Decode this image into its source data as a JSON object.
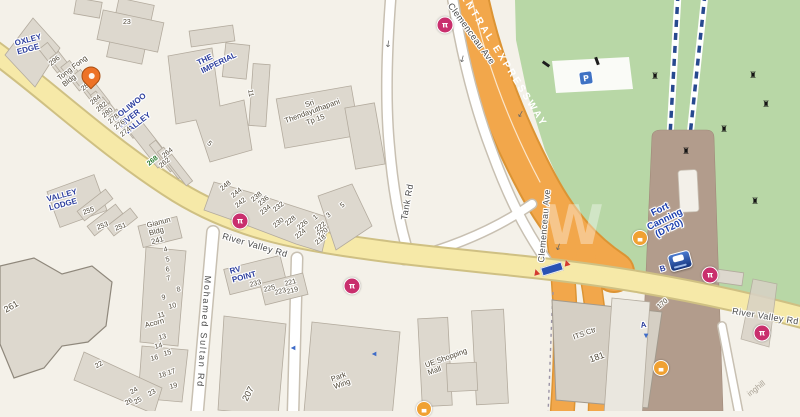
{
  "map": {
    "area_name": "River Valley / Fort Canning",
    "palette": {
      "background": "#f4f1e9",
      "park_green": "#b8d7a6",
      "expressway_orange": "#f2a74b",
      "expressway_casing": "#dc9434",
      "road_yellow": "#f6e9a8",
      "road_yellow_casing": "#cfc083",
      "road_white": "#ffffff",
      "road_white_casing": "#c8c0b2",
      "station_strip_brown": "#b29c8c",
      "building_fill": "#ddd8ce",
      "building_stroke": "#b3ab9e",
      "condo_blue": "#2c3e9e",
      "station_blue": "#1c3fae",
      "erp_magenta": "#c92f6d",
      "taxi_orange": "#f0a132",
      "parking_blue": "#3f72c4",
      "mrt_line_blue": "#27498f",
      "number_green": "#2e7d32"
    },
    "road_names": [
      "River Valley Rd",
      "Mohamed Sultan Rd",
      "Tank Rd",
      "Clemenceau Ave",
      "CENTRAL EXPRESSWAY"
    ],
    "labels": [
      {
        "t": "OXLEY\nEDGE",
        "x": 14,
        "y": 40,
        "r": -15,
        "c": "place",
        "n": "label-oxley-edge"
      },
      {
        "t": "THE\nIMPERIAL",
        "x": 196,
        "y": 60,
        "r": -26,
        "c": "place",
        "n": "label-the-imperial"
      },
      {
        "t": "COLIWOO\nRIVER\nVALLEY",
        "x": 112,
        "y": 116,
        "r": -38,
        "c": "place",
        "n": "label-coliwoo-river-valley"
      },
      {
        "t": "268",
        "x": 146,
        "y": 162,
        "r": -38,
        "c": "num g",
        "n": "label-268"
      },
      {
        "t": "VALLEY\nLODGE",
        "x": 46,
        "y": 196,
        "r": -15,
        "c": "place",
        "n": "label-valley-lodge"
      },
      {
        "t": "RV\nPOINT",
        "x": 229,
        "y": 268,
        "r": -15,
        "c": "place",
        "n": "label-rv-point"
      },
      {
        "t": "Fort\nCanning\n(DT20)",
        "x": 641,
        "y": 214,
        "r": -26,
        "c": "station ctr",
        "n": "label-fort-canning-dt20"
      },
      {
        "t": "Tong Fong\nBldg",
        "x": 56,
        "y": 76,
        "r": -38,
        "c": "bldg",
        "n": "label-tong-fong-bldg"
      },
      {
        "t": "Sri\nThendayuthapani\nTp 15",
        "x": 281,
        "y": 110,
        "r": -20,
        "c": "bldg ctr",
        "n": "label-sri-thendayuthapani"
      },
      {
        "t": "Gianun\nBldg\n241",
        "x": 146,
        "y": 222,
        "r": -15,
        "c": "bldg",
        "n": "label-gianun-bldg-241"
      },
      {
        "t": "Acorn",
        "x": 144,
        "y": 322,
        "r": -15,
        "c": "bldg",
        "n": "label-acorn"
      },
      {
        "t": "Park\nWing",
        "x": 330,
        "y": 376,
        "r": -20,
        "c": "bldg",
        "n": "label-park-wing"
      },
      {
        "t": "UE Shopping\nMall",
        "x": 424,
        "y": 362,
        "r": -20,
        "c": "bldg",
        "n": "label-ue-shopping-mall"
      },
      {
        "t": "ITS Ctr",
        "x": 572,
        "y": 334,
        "r": -20,
        "c": "bldg",
        "n": "label-its-ctr"
      },
      {
        "t": "inghill",
        "x": 746,
        "y": 392,
        "r": -38,
        "c": "faint",
        "n": "label-inghill"
      },
      {
        "t": "River Valley Rd",
        "x": 224,
        "y": 231,
        "r": 16,
        "c": "road",
        "n": "label-river-valley-rd-west"
      },
      {
        "t": "River Valley Rd",
        "x": 733,
        "y": 306,
        "r": 9,
        "c": "road",
        "n": "label-river-valley-rd-east"
      },
      {
        "t": "Mohamed Sultan Rd",
        "x": 213,
        "y": 276,
        "r": 94,
        "ls": 1.8,
        "c": "road",
        "n": "label-mohamed-sultan-rd"
      },
      {
        "t": "Tank Rd",
        "x": 399,
        "y": 219,
        "r": -80,
        "ls": 0.5,
        "c": "road",
        "n": "label-tank-rd"
      },
      {
        "t": "Clemenceau Ave",
        "x": 454,
        "y": 1,
        "r": 54,
        "c": "road",
        "n": "label-clemenceau-ave-north"
      },
      {
        "t": "Clemenceau Ave",
        "x": 536,
        "y": 262,
        "r": -85,
        "c": "road",
        "n": "label-clemenceau-ave-mid"
      },
      {
        "t": "CENTRAL EXPRESSWAY",
        "x": 462,
        "y": -16,
        "r": 58,
        "c": "xway",
        "n": "label-central-expressway"
      },
      {
        "t": "23",
        "x": 123,
        "y": 19,
        "r": 0,
        "c": "num"
      },
      {
        "t": "296",
        "x": 48,
        "y": 62,
        "r": -38,
        "c": "num"
      },
      {
        "t": "288",
        "x": 80,
        "y": 87,
        "r": -38,
        "c": "num"
      },
      {
        "t": "284",
        "x": 89,
        "y": 101,
        "r": -38,
        "c": "num"
      },
      {
        "t": "282",
        "x": 95,
        "y": 108,
        "r": -38,
        "c": "num"
      },
      {
        "t": "280",
        "x": 101,
        "y": 114,
        "r": -38,
        "c": "num"
      },
      {
        "t": "278",
        "x": 107,
        "y": 120,
        "r": -38,
        "c": "num"
      },
      {
        "t": "276",
        "x": 113,
        "y": 126,
        "r": -38,
        "c": "num"
      },
      {
        "t": "274",
        "x": 119,
        "y": 133,
        "r": -38,
        "c": "num"
      },
      {
        "t": "264",
        "x": 161,
        "y": 154,
        "r": -38,
        "c": "num"
      },
      {
        "t": "262",
        "x": 158,
        "y": 164,
        "r": -38,
        "c": "num"
      },
      {
        "t": "11",
        "x": 253,
        "y": 89,
        "r": 80,
        "c": "num"
      },
      {
        "t": "5",
        "x": 210,
        "y": 140,
        "r": 40,
        "c": "num"
      },
      {
        "t": "255",
        "x": 82,
        "y": 210,
        "r": -20,
        "c": "num"
      },
      {
        "t": "253",
        "x": 96,
        "y": 225,
        "r": -20,
        "c": "num"
      },
      {
        "t": "251",
        "x": 114,
        "y": 226,
        "r": -20,
        "c": "num"
      },
      {
        "t": "248",
        "x": 219,
        "y": 187,
        "r": -38,
        "c": "num"
      },
      {
        "t": "244",
        "x": 230,
        "y": 194,
        "r": -38,
        "c": "num"
      },
      {
        "t": "242",
        "x": 234,
        "y": 204,
        "r": -38,
        "c": "num"
      },
      {
        "t": "238",
        "x": 250,
        "y": 198,
        "r": -38,
        "c": "num"
      },
      {
        "t": "236",
        "x": 257,
        "y": 202,
        "r": -38,
        "c": "num"
      },
      {
        "t": "234",
        "x": 259,
        "y": 211,
        "r": -38,
        "c": "num"
      },
      {
        "t": "232",
        "x": 272,
        "y": 208,
        "r": -38,
        "c": "num"
      },
      {
        "t": "230",
        "x": 272,
        "y": 224,
        "r": -38,
        "c": "num"
      },
      {
        "t": "228",
        "x": 284,
        "y": 222,
        "r": -38,
        "c": "num"
      },
      {
        "t": "226",
        "x": 296,
        "y": 226,
        "r": -38,
        "c": "num"
      },
      {
        "t": "224",
        "x": 294,
        "y": 235,
        "r": -38,
        "c": "num"
      },
      {
        "t": "222",
        "x": 314,
        "y": 228,
        "r": -38,
        "c": "num"
      },
      {
        "t": "220",
        "x": 316,
        "y": 234,
        "r": -38,
        "c": "num"
      },
      {
        "t": "218",
        "x": 314,
        "y": 241,
        "r": -38,
        "c": "num"
      },
      {
        "t": "1",
        "x": 312,
        "y": 216,
        "r": -38,
        "c": "num"
      },
      {
        "t": "3",
        "x": 325,
        "y": 214,
        "r": -38,
        "c": "num"
      },
      {
        "t": "5",
        "x": 339,
        "y": 204,
        "r": -38,
        "c": "num"
      },
      {
        "t": "233",
        "x": 249,
        "y": 282,
        "r": -15,
        "c": "num"
      },
      {
        "t": "225",
        "x": 263,
        "y": 287,
        "r": -15,
        "c": "num"
      },
      {
        "t": "223",
        "x": 274,
        "y": 290,
        "r": -15,
        "c": "num"
      },
      {
        "t": "221",
        "x": 284,
        "y": 281,
        "r": -15,
        "c": "num"
      },
      {
        "t": "219",
        "x": 286,
        "y": 289,
        "r": -15,
        "c": "num"
      },
      {
        "t": "4",
        "x": 163,
        "y": 247,
        "r": -15,
        "c": "num"
      },
      {
        "t": "5",
        "x": 165,
        "y": 257,
        "r": -15,
        "c": "num"
      },
      {
        "t": "6",
        "x": 165,
        "y": 267,
        "r": -15,
        "c": "num"
      },
      {
        "t": "7",
        "x": 166,
        "y": 276,
        "r": -15,
        "c": "num"
      },
      {
        "t": "8",
        "x": 176,
        "y": 287,
        "r": -15,
        "c": "num"
      },
      {
        "t": "9",
        "x": 161,
        "y": 295,
        "r": -15,
        "c": "num"
      },
      {
        "t": "10",
        "x": 168,
        "y": 304,
        "r": -15,
        "c": "num"
      },
      {
        "t": "11",
        "x": 157,
        "y": 313,
        "r": -15,
        "c": "num"
      },
      {
        "t": "13",
        "x": 158,
        "y": 335,
        "r": -15,
        "c": "num"
      },
      {
        "t": "14",
        "x": 154,
        "y": 344,
        "r": -15,
        "c": "num"
      },
      {
        "t": "15",
        "x": 163,
        "y": 351,
        "r": -15,
        "c": "num"
      },
      {
        "t": "16",
        "x": 150,
        "y": 356,
        "r": -15,
        "c": "num"
      },
      {
        "t": "17",
        "x": 167,
        "y": 370,
        "r": -15,
        "c": "num"
      },
      {
        "t": "18",
        "x": 158,
        "y": 373,
        "r": -15,
        "c": "num"
      },
      {
        "t": "19",
        "x": 169,
        "y": 384,
        "r": -15,
        "c": "num"
      },
      {
        "t": "22",
        "x": 94,
        "y": 364,
        "r": -30,
        "c": "num"
      },
      {
        "t": "24",
        "x": 129,
        "y": 390,
        "r": -30,
        "c": "num"
      },
      {
        "t": "23",
        "x": 147,
        "y": 392,
        "r": -30,
        "c": "num"
      },
      {
        "t": "25",
        "x": 133,
        "y": 400,
        "r": -30,
        "c": "num"
      },
      {
        "t": "26",
        "x": 124,
        "y": 401,
        "r": -30,
        "c": "num"
      },
      {
        "t": "261",
        "x": 2,
        "y": 306,
        "r": -30,
        "c": "num big",
        "n": "label-261"
      },
      {
        "t": "207",
        "x": 240,
        "y": 398,
        "r": -62,
        "c": "num big",
        "n": "label-207"
      },
      {
        "t": "181",
        "x": 588,
        "y": 355,
        "r": -20,
        "c": "num big",
        "n": "label-181"
      },
      {
        "t": "170",
        "x": 656,
        "y": 305,
        "r": -40,
        "c": "num",
        "n": "label-170"
      },
      {
        "t": "A",
        "x": 640,
        "y": 322,
        "r": -10,
        "c": "place",
        "n": "label-exit-a"
      },
      {
        "t": "B",
        "x": 659,
        "y": 266,
        "r": -15,
        "c": "place",
        "n": "label-exit-b"
      },
      {
        "t": "W",
        "x": 544,
        "y": 196,
        "r": 0,
        "c": "wm",
        "n": "watermark"
      }
    ],
    "icons": [
      {
        "type": "pin",
        "x": 91,
        "y": 76,
        "r": -45,
        "i": true,
        "n": "destination-pin-icon"
      },
      {
        "type": "erp",
        "glyph": "π",
        "x": 240,
        "y": 221,
        "i": true,
        "n": "erp-gantry-icon"
      },
      {
        "type": "erp",
        "glyph": "π",
        "x": 352,
        "y": 286,
        "i": true,
        "n": "erp-gantry-icon"
      },
      {
        "type": "erp",
        "glyph": "π",
        "x": 445,
        "y": 25,
        "i": true,
        "n": "erp-gantry-icon"
      },
      {
        "type": "erp",
        "glyph": "π",
        "x": 710,
        "y": 275,
        "i": true,
        "n": "erp-gantry-icon"
      },
      {
        "type": "erp",
        "glyph": "π",
        "x": 762,
        "y": 333,
        "i": true,
        "n": "erp-gantry-icon"
      },
      {
        "type": "taxi",
        "glyph": "▄",
        "x": 640,
        "y": 238,
        "i": true,
        "n": "taxi-stand-icon"
      },
      {
        "type": "taxi",
        "glyph": "▄",
        "x": 661,
        "y": 368,
        "i": true,
        "n": "taxi-stand-icon"
      },
      {
        "type": "taxi",
        "glyph": "▄",
        "x": 424,
        "y": 409,
        "i": true,
        "n": "taxi-stand-icon"
      },
      {
        "type": "mrt",
        "x": 680,
        "y": 261,
        "r": -15,
        "i": true,
        "n": "mrt-station-icon"
      },
      {
        "type": "parking",
        "glyph": "P",
        "x": 586,
        "y": 78,
        "r": -8,
        "i": true,
        "n": "parking-icon"
      },
      {
        "type": "gsign",
        "x": 552,
        "y": 269,
        "r": -17,
        "i": false,
        "n": "erp-sign-icon"
      },
      {
        "type": "shelter",
        "x": 546,
        "y": 64,
        "r": -55,
        "i": false,
        "n": "shelter-icon"
      },
      {
        "type": "shelter",
        "x": 597,
        "y": 61,
        "r": -20,
        "i": false,
        "n": "shelter-icon"
      },
      {
        "type": "monument",
        "glyph": "♜",
        "x": 655,
        "y": 77,
        "i": false,
        "n": "monument-icon"
      },
      {
        "type": "monument",
        "glyph": "♜",
        "x": 753,
        "y": 76,
        "i": false,
        "n": "monument-icon"
      },
      {
        "type": "monument",
        "glyph": "♜",
        "x": 766,
        "y": 105,
        "i": false,
        "n": "monument-icon"
      },
      {
        "type": "monument",
        "glyph": "♜",
        "x": 724,
        "y": 130,
        "i": false,
        "n": "monument-icon"
      },
      {
        "type": "monument",
        "glyph": "♜",
        "x": 686,
        "y": 152,
        "i": false,
        "n": "monument-icon"
      },
      {
        "type": "monument",
        "glyph": "♜",
        "x": 755,
        "y": 202,
        "i": false,
        "n": "monument-icon"
      },
      {
        "type": "arrow-left",
        "glyph": "◀",
        "x": 293,
        "y": 348,
        "i": false,
        "n": "direction-arrow-icon"
      },
      {
        "type": "arrow-left",
        "glyph": "◀",
        "x": 374,
        "y": 354,
        "i": false,
        "n": "direction-arrow-icon"
      },
      {
        "type": "arrow-down",
        "glyph": "▼",
        "x": 646,
        "y": 336,
        "i": false,
        "n": "direction-arrow-icon"
      },
      {
        "type": "flow",
        "glyph": "↓",
        "x": 388,
        "y": 45,
        "r": 8,
        "i": false,
        "n": "traffic-flow-arrow-icon"
      },
      {
        "type": "flow",
        "glyph": "↓",
        "x": 520,
        "y": 115,
        "r": 30,
        "i": false,
        "n": "traffic-flow-arrow-icon"
      },
      {
        "type": "flow",
        "glyph": "↓",
        "x": 558,
        "y": 248,
        "r": 20,
        "i": false,
        "n": "traffic-flow-arrow-icon"
      },
      {
        "type": "flow",
        "glyph": "↓",
        "x": 462,
        "y": 60,
        "r": 15,
        "i": false,
        "n": "traffic-flow-arrow-icon"
      }
    ]
  }
}
